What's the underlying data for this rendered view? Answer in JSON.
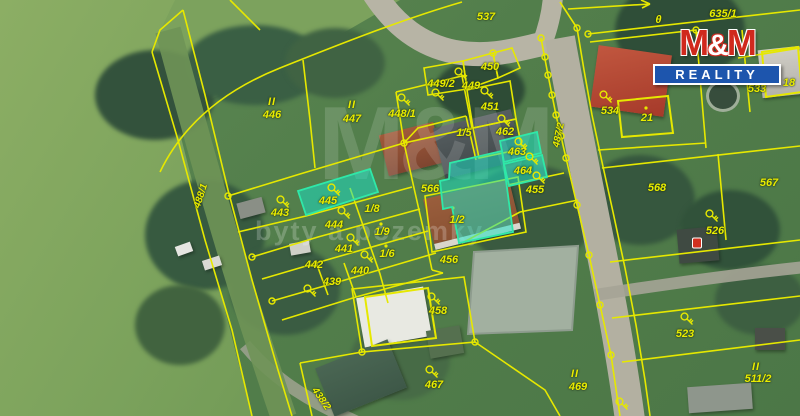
{
  "canvas": {
    "width": 800,
    "height": 416
  },
  "branding": {
    "logo": {
      "m_left": "M",
      "ampersand": "&",
      "m_right": "M",
      "banner": "REALITY",
      "red": "#d0291d",
      "blue": "#1d55ad"
    }
  },
  "watermark": {
    "ghost_logo": "M&M",
    "slogan": "byty a pozemky"
  },
  "map": {
    "line_color": "#e6e800",
    "label_color": "#e9ed00",
    "highlight_color": "#1ee2c5",
    "parcel_labels": [
      {
        "text": "537",
        "x": 486,
        "y": 17
      },
      {
        "text": "635/1",
        "x": 723,
        "y": 14
      },
      {
        "text": "446",
        "x": 272,
        "y": 115
      },
      {
        "text": "447",
        "x": 352,
        "y": 119
      },
      {
        "text": "448/1",
        "x": 402,
        "y": 114
      },
      {
        "text": "449/2",
        "x": 441,
        "y": 84
      },
      {
        "text": "449",
        "x": 471,
        "y": 86
      },
      {
        "text": "450",
        "x": 490,
        "y": 67
      },
      {
        "text": "451",
        "x": 490,
        "y": 107
      },
      {
        "text": "462",
        "x": 505,
        "y": 132
      },
      {
        "text": "1/5",
        "x": 464,
        "y": 133
      },
      {
        "text": "463",
        "x": 517,
        "y": 152
      },
      {
        "text": "464",
        "x": 523,
        "y": 171
      },
      {
        "text": "455",
        "x": 535,
        "y": 190
      },
      {
        "text": "566",
        "x": 430,
        "y": 189
      },
      {
        "text": "1/2",
        "x": 457,
        "y": 220
      },
      {
        "text": "445",
        "x": 328,
        "y": 201
      },
      {
        "text": "443",
        "x": 280,
        "y": 213
      },
      {
        "text": "1/8",
        "x": 372,
        "y": 209
      },
      {
        "text": "444",
        "x": 334,
        "y": 225
      },
      {
        "text": "1/9",
        "x": 382,
        "y": 232
      },
      {
        "text": "441",
        "x": 344,
        "y": 249
      },
      {
        "text": "1/6",
        "x": 387,
        "y": 254
      },
      {
        "text": "442",
        "x": 314,
        "y": 265
      },
      {
        "text": "440",
        "x": 360,
        "y": 271
      },
      {
        "text": "439",
        "x": 332,
        "y": 282
      },
      {
        "text": "456",
        "x": 449,
        "y": 260
      },
      {
        "text": "458",
        "x": 438,
        "y": 311
      },
      {
        "text": "467",
        "x": 434,
        "y": 385
      },
      {
        "text": "534",
        "x": 610,
        "y": 111
      },
      {
        "text": "21",
        "x": 647,
        "y": 118
      },
      {
        "text": "533",
        "x": 757,
        "y": 89
      },
      {
        "text": "18",
        "x": 789,
        "y": 83
      },
      {
        "text": "568",
        "x": 657,
        "y": 188
      },
      {
        "text": "567",
        "x": 769,
        "y": 183
      },
      {
        "text": "526",
        "x": 715,
        "y": 231
      },
      {
        "text": "523",
        "x": 685,
        "y": 334
      },
      {
        "text": "511/2",
        "x": 758,
        "y": 379
      },
      {
        "text": "469",
        "x": 578,
        "y": 387
      }
    ],
    "road_labels": [
      {
        "text": "487/2",
        "x": 559,
        "y": 135,
        "rot": -78
      },
      {
        "text": "488/1",
        "x": 201,
        "y": 196,
        "rot": -72
      },
      {
        "text": "438/2",
        "x": 321,
        "y": 399,
        "rot": 55
      }
    ],
    "landuse_marks": [
      {
        "text": "II",
        "x": 272,
        "y": 102
      },
      {
        "text": "II",
        "x": 352,
        "y": 105
      },
      {
        "text": "II",
        "x": 575,
        "y": 374
      },
      {
        "text": "II",
        "x": 756,
        "y": 367
      },
      {
        "text": "θ",
        "x": 659,
        "y": 20
      }
    ],
    "key_icons": [
      {
        "x": 404,
        "y": 100
      },
      {
        "x": 438,
        "y": 95
      },
      {
        "x": 461,
        "y": 74
      },
      {
        "x": 487,
        "y": 93
      },
      {
        "x": 504,
        "y": 121
      },
      {
        "x": 521,
        "y": 144
      },
      {
        "x": 532,
        "y": 159
      },
      {
        "x": 539,
        "y": 178
      },
      {
        "x": 334,
        "y": 190
      },
      {
        "x": 283,
        "y": 202
      },
      {
        "x": 344,
        "y": 213
      },
      {
        "x": 353,
        "y": 240
      },
      {
        "x": 367,
        "y": 257
      },
      {
        "x": 310,
        "y": 291
      },
      {
        "x": 434,
        "y": 299
      },
      {
        "x": 432,
        "y": 372
      },
      {
        "x": 606,
        "y": 97
      },
      {
        "x": 757,
        "y": 75
      },
      {
        "x": 712,
        "y": 216
      },
      {
        "x": 687,
        "y": 319
      },
      {
        "x": 622,
        "y": 404
      }
    ],
    "poi_markers": [
      {
        "x": 697,
        "y": 243,
        "color": "#d03020"
      }
    ]
  }
}
